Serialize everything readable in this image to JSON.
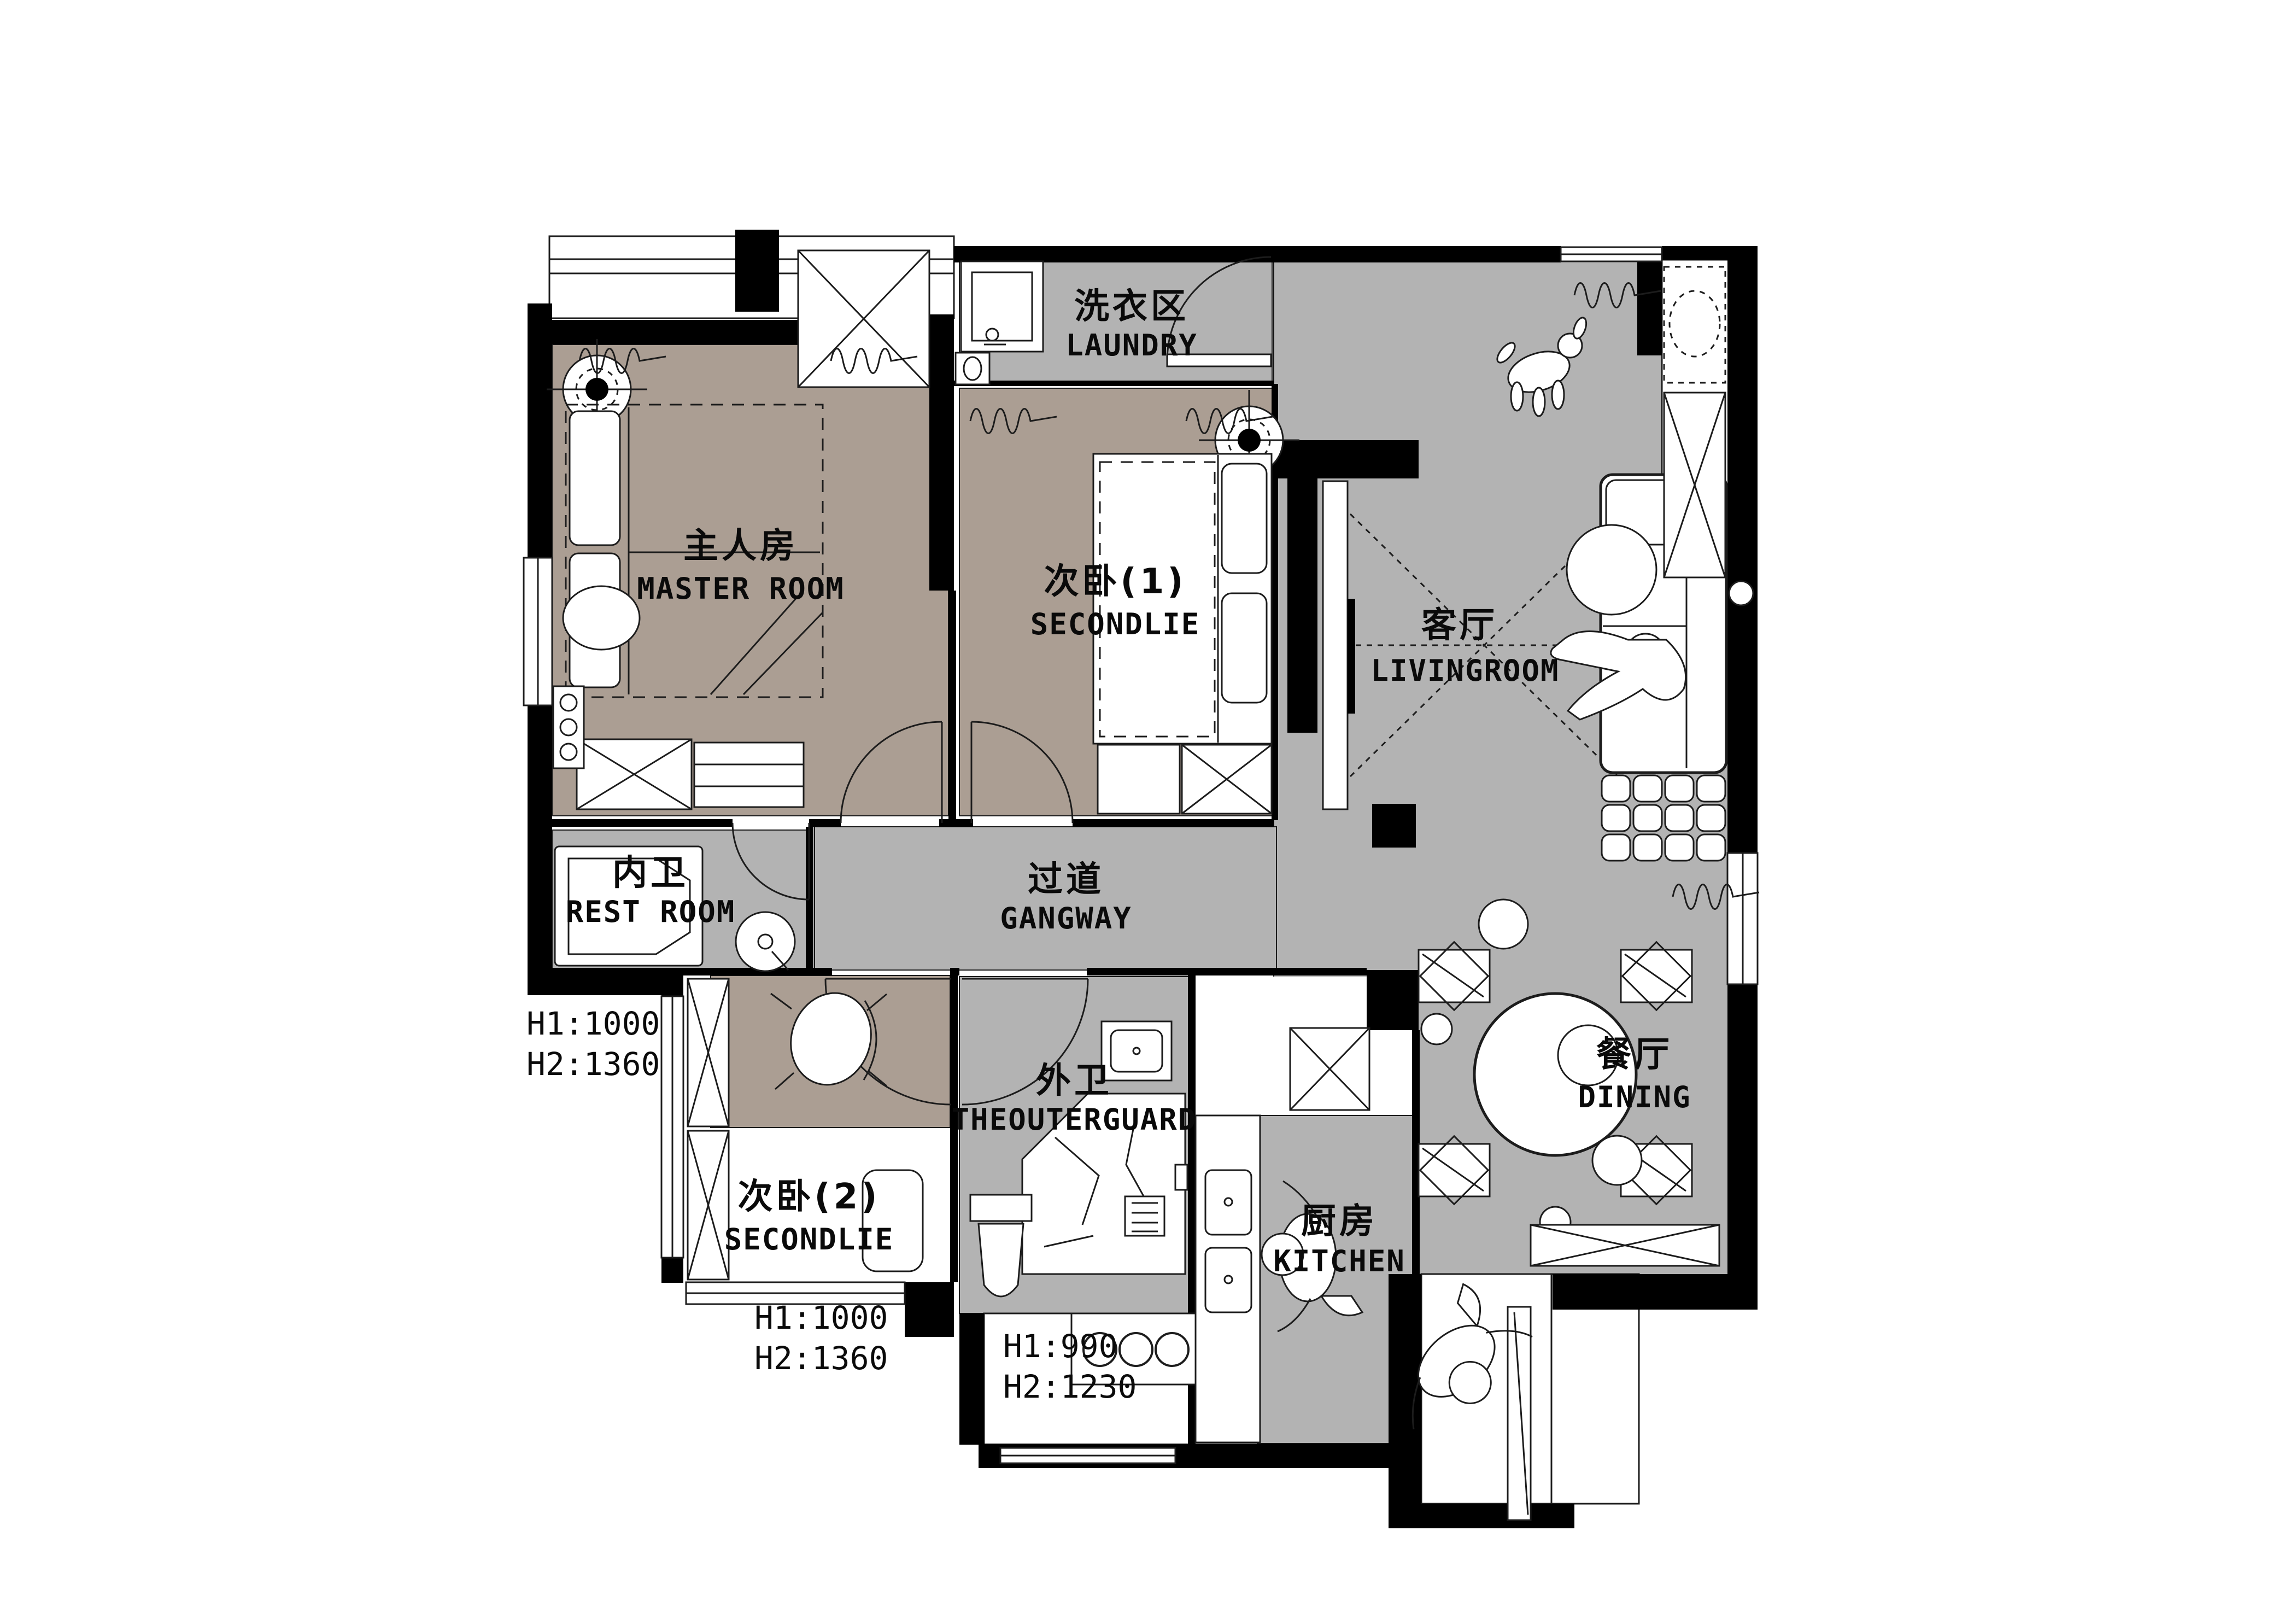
{
  "plan": {
    "type": "apartment-floor-plan",
    "rooms": [
      {
        "id": "master",
        "cn": "主人房",
        "en": "MASTER ROOM"
      },
      {
        "id": "bedroom1",
        "cn": "次卧(1)",
        "en": "SECONDLIE"
      },
      {
        "id": "bedroom2",
        "cn": "次卧(2)",
        "en": "SECONDLIE"
      },
      {
        "id": "living",
        "cn": "客厅",
        "en": "LIVINGROOM"
      },
      {
        "id": "dining",
        "cn": "餐厅",
        "en": "DINING"
      },
      {
        "id": "kitchen",
        "cn": "厨房",
        "en": "KITCHEN"
      },
      {
        "id": "laundry",
        "cn": "洗衣区",
        "en": "LAUNDRY"
      },
      {
        "id": "restroom",
        "cn": "内卫",
        "en": "REST ROOM"
      },
      {
        "id": "outerguard",
        "cn": "外卫",
        "en": "THEOUTERGUARD"
      },
      {
        "id": "gangway",
        "cn": "过道",
        "en": "GANGWAY"
      }
    ],
    "annotations": [
      {
        "id": "dim-left",
        "line1": "H1:1000",
        "line2": "H2:1360"
      },
      {
        "id": "dim-bottom-left",
        "line1": "H1:1000",
        "line2": "H2:1360"
      },
      {
        "id": "dim-bottom-center",
        "line1": "H1:990",
        "line2": "H2:1230"
      }
    ],
    "colors": {
      "floor_warm": "#ab9e93",
      "floor_gray": "#b3b3b3",
      "wall": "#000000",
      "line": "#1c1c1c",
      "background": "#ffffff"
    }
  }
}
